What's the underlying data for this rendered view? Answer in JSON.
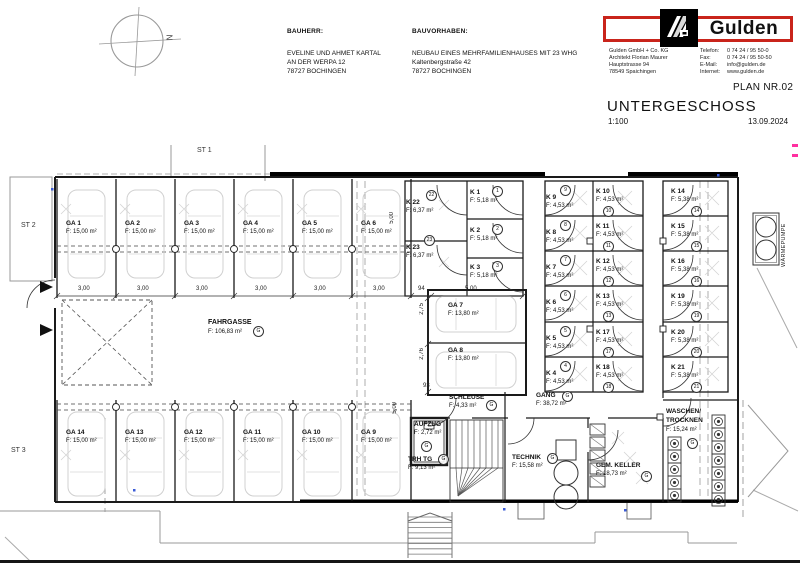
{
  "header": {
    "bauherr_label": "BAUHERR:",
    "bauherr_line1": "EVELINE UND AHMET KARTAL",
    "bauherr_line2": "AN DER WERPA 12",
    "bauherr_line3": "78727 BOCHINGEN",
    "bauvorhaben_label": "BAUVORHABEN:",
    "bauvorhaben_line1": "NEUBAU EINES MEHRFAMILIENHAUSES MIT 23 WHG",
    "bauvorhaben_line2": "Kaltenbergstraße 42",
    "bauvorhaben_line3": "78727 BOCHINGEN"
  },
  "firm": {
    "logo_text": "Gulden",
    "name": "Gulden GmbH + Co. KG",
    "architect": "Architekt Florian Maurer",
    "street": "Hauptstrasse 94",
    "city": "78549 Spaichingen",
    "tel_label": "Telefon:",
    "tel": "0 74 24 / 95 50-0",
    "fax_label": "Fax:",
    "fax": "0 74 24 / 95 50-50",
    "email_label": "E-Mail:",
    "email": "info@gulden.de",
    "web_label": "Internet:",
    "web": "www.gulden.de"
  },
  "plan": {
    "number": "PLAN NR.02",
    "title": "UNTERGESCHOSS",
    "scale": "1:100",
    "date": "13.09.2024"
  },
  "site": {
    "st1": "ST 1",
    "st2": "ST 2",
    "st3": "ST 3",
    "north": "N",
    "waermepumpe": "WÄRMEPUMPE"
  },
  "misc": {
    "g": "G"
  },
  "dims": {
    "d300": "3,00",
    "d500": "5,00",
    "d94": "94",
    "d93": "93",
    "d275": "2,75",
    "d276": "2,76"
  },
  "rooms": {
    "ga1": {
      "name": "GA 1",
      "area": "F: 15,00 m²"
    },
    "ga2": {
      "name": "GA 2",
      "area": "F: 15,00 m²"
    },
    "ga3": {
      "name": "GA 3",
      "area": "F: 15,00 m²"
    },
    "ga4": {
      "name": "GA 4",
      "area": "F: 15,00 m²"
    },
    "ga5": {
      "name": "GA 5",
      "area": "F: 15,00 m²"
    },
    "ga6": {
      "name": "GA 6",
      "area": "F: 15,00 m²"
    },
    "ga7": {
      "name": "GA 7",
      "area": "F: 13,80 m²"
    },
    "ga8": {
      "name": "GA 8",
      "area": "F: 13,80 m²"
    },
    "ga9": {
      "name": "GA 9",
      "area": "F: 15,00 m²"
    },
    "ga10": {
      "name": "GA 10",
      "area": "F: 15,00 m²"
    },
    "ga11": {
      "name": "GA 11",
      "area": "F: 15,00 m²"
    },
    "ga12": {
      "name": "GA 12",
      "area": "F: 15,00 m²"
    },
    "ga13": {
      "name": "GA 13",
      "area": "F: 15,00 m²"
    },
    "ga14": {
      "name": "GA 14",
      "area": "F: 15,00 m²"
    },
    "k1": {
      "name": "K 1",
      "area": "F: 5,18 m²",
      "num": "1"
    },
    "k2": {
      "name": "K 2",
      "area": "F: 5,18 m²",
      "num": "2"
    },
    "k3": {
      "name": "K 3",
      "area": "F: 5,18 m²",
      "num": "3"
    },
    "k4": {
      "name": "K 4",
      "area": "F: 4,53 m²",
      "num": "4"
    },
    "k5": {
      "name": "K 5",
      "area": "F: 4,53 m²",
      "num": "5"
    },
    "k6": {
      "name": "K 6",
      "area": "F: 4,53 m²",
      "num": "6"
    },
    "k7": {
      "name": "K 7",
      "area": "F: 4,53 m²",
      "num": "7"
    },
    "k8": {
      "name": "K 8",
      "area": "F: 4,53 m²",
      "num": "8"
    },
    "k9": {
      "name": "K 9",
      "area": "F: 4,53 m²",
      "num": "9"
    },
    "k10": {
      "name": "K 10",
      "area": "F: 4,53 m²",
      "num": "10"
    },
    "k11": {
      "name": "K 11",
      "area": "F: 4,53 m²",
      "num": "11"
    },
    "k12": {
      "name": "K 12",
      "area": "F: 4,53 m²",
      "num": "12"
    },
    "k13": {
      "name": "K 13",
      "area": "F: 4,53 m²",
      "num": "13"
    },
    "k14": {
      "name": "K 14",
      "area": "F: 5,38 m²",
      "num": "14"
    },
    "k15": {
      "name": "K 15",
      "area": "F: 5,38 m²",
      "num": "15"
    },
    "k16": {
      "name": "K 16",
      "area": "F: 5,38 m²",
      "num": "16"
    },
    "k17": {
      "name": "K 17",
      "area": "F: 4,53 m²",
      "num": "17"
    },
    "k18": {
      "name": "K 18",
      "area": "F: 4,53 m²",
      "num": "18"
    },
    "k19": {
      "name": "K 19",
      "area": "F: 5,38 m²",
      "num": "19"
    },
    "k20": {
      "name": "K 20",
      "area": "F: 5,38 m²",
      "num": "20"
    },
    "k21": {
      "name": "K 21",
      "area": "F: 5,38 m²",
      "num": "21"
    },
    "k22": {
      "name": "K 22",
      "area": "F: 6,37 m²",
      "num": "22"
    },
    "k23": {
      "name": "K 23",
      "area": "F: 6,37 m²",
      "num": "23"
    },
    "fahrgasse": {
      "name": "FAHRGASSE",
      "area": "F: 106,83 m²"
    },
    "schleuse": {
      "name": "SCHLEUSE",
      "area": "F: 4,33 m²"
    },
    "gang": {
      "name": "GANG",
      "area": "F: 38,72 m²"
    },
    "aufzug": {
      "name": "AUFZUG",
      "area": "F: 2,72 m²"
    },
    "trhtg": {
      "name": "TRH TG",
      "area": "F: 9,13 m²"
    },
    "technik": {
      "name": "TECHNIK",
      "area": "F: 15,58 m²"
    },
    "gemkeller": {
      "name": "GEM. KELLER",
      "area": "F: 18,73 m²"
    },
    "waschen": {
      "name1": "WASCHEN/",
      "name2": "TROCKNEN",
      "area": "F: 15,24 m²"
    }
  }
}
